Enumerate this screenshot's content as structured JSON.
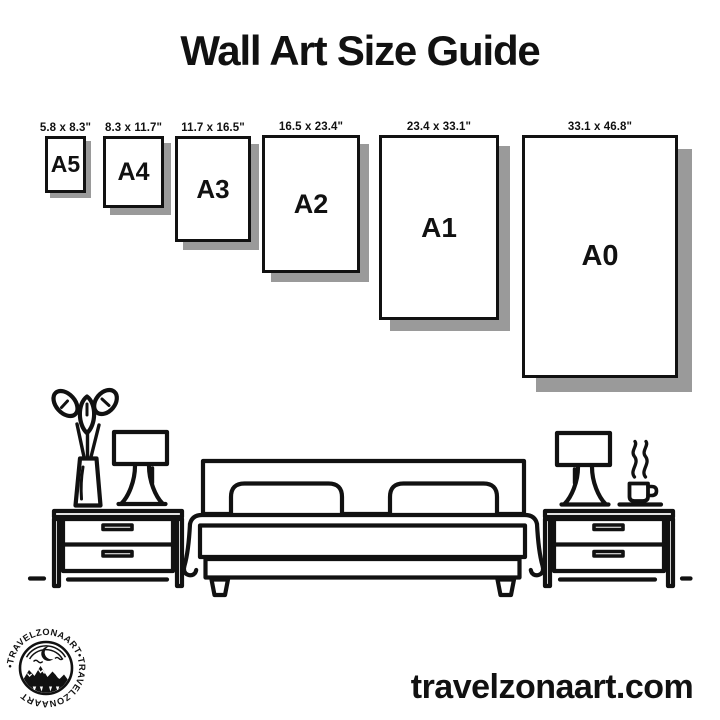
{
  "title": "Wall Art Size Guide",
  "sizes": [
    {
      "code": "A5",
      "dims": "5.8 x 8.3\""
    },
    {
      "code": "A4",
      "dims": "8.3 x 11.7\""
    },
    {
      "code": "A3",
      "dims": "11.7 x 16.5\""
    },
    {
      "code": "A2",
      "dims": "16.5 x 23.4\""
    },
    {
      "code": "A1",
      "dims": "23.4 x 33.1\""
    },
    {
      "code": "A0",
      "dims": "33.1 x 46.8\""
    }
  ],
  "logo": {
    "ring_text": "•TRAVELZONAART•TRAVELZONAART"
  },
  "footer": {
    "website": "travelzonaart.com"
  },
  "colors": {
    "ink": "#111111",
    "frame_shadow": "#9a9a9a",
    "background": "#ffffff"
  }
}
